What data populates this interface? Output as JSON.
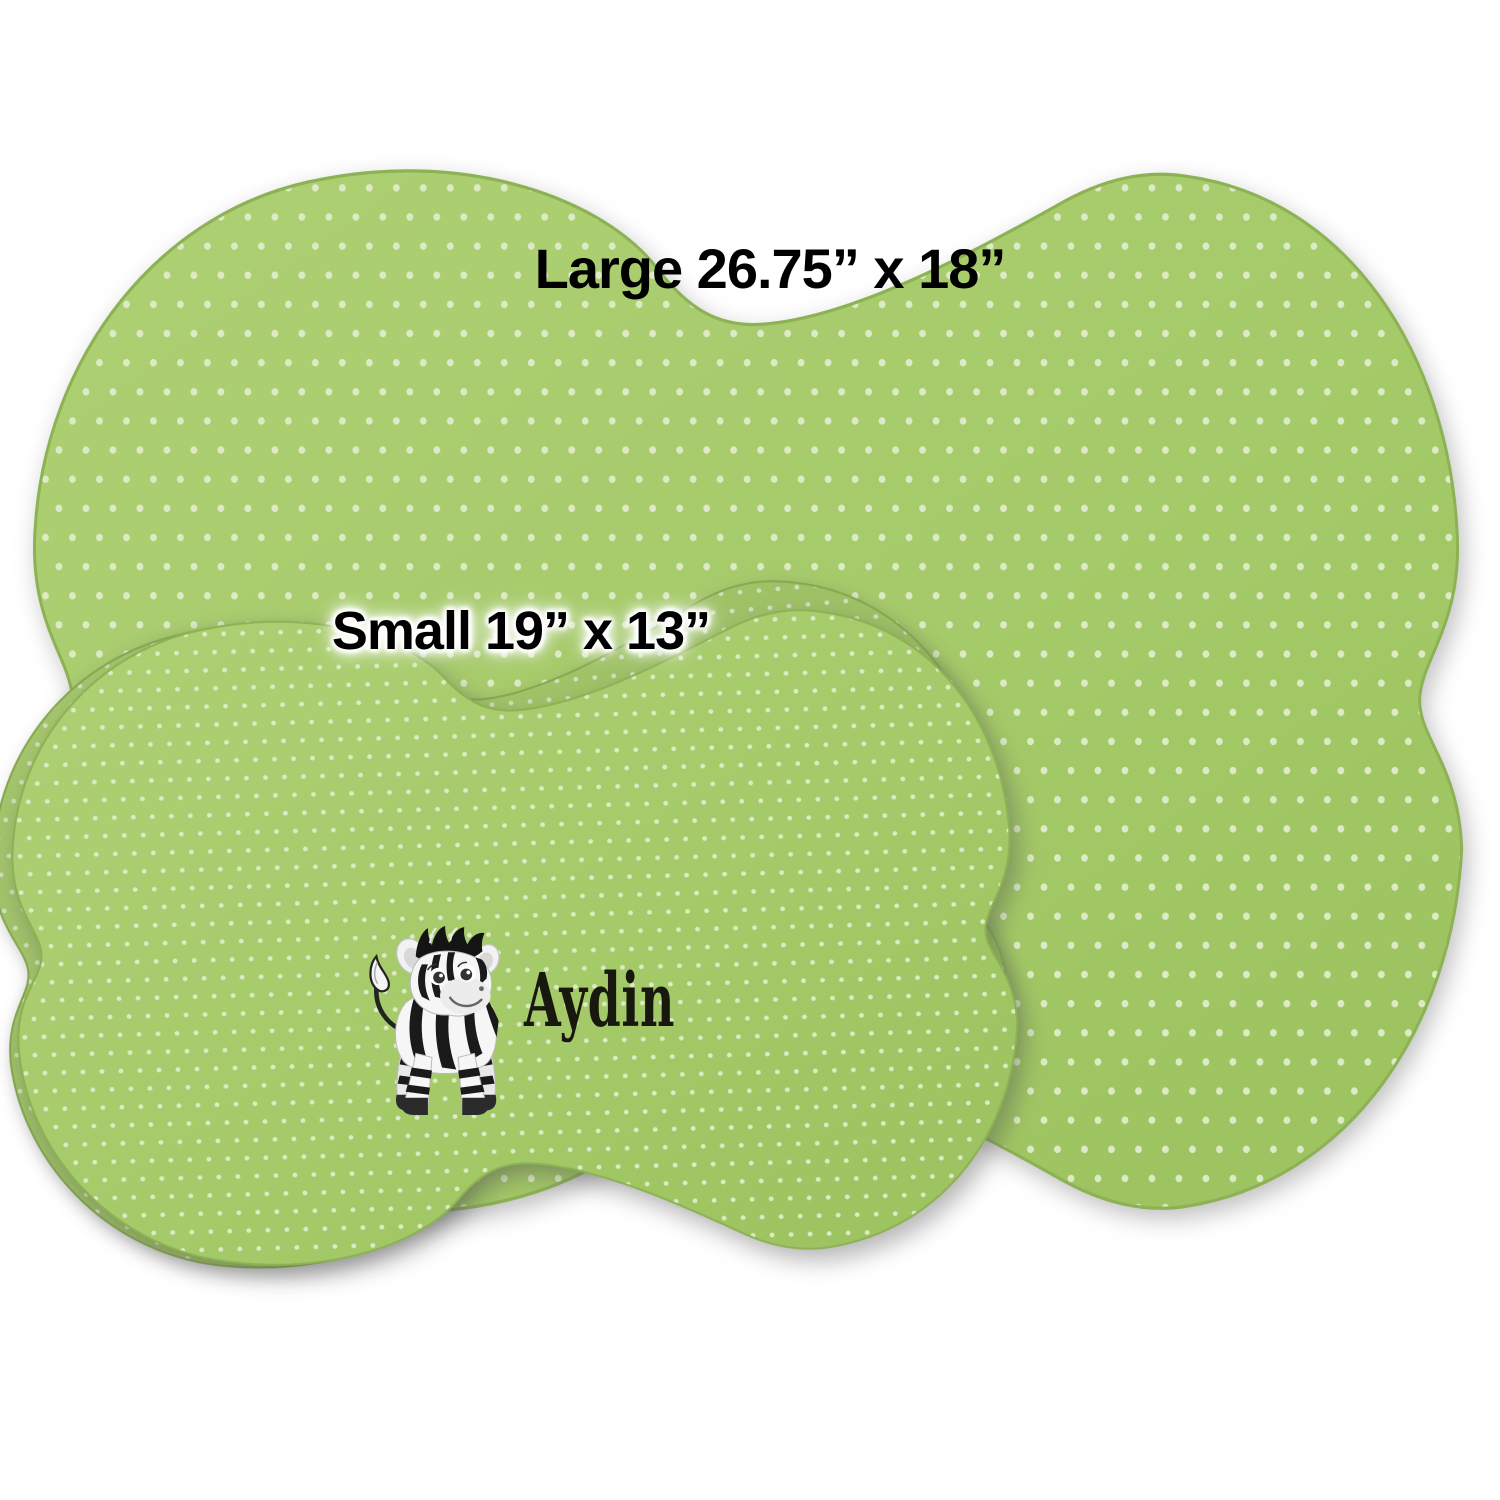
{
  "product_preview": {
    "large_size_label": "Large 26.75” x 18”",
    "small_size_label": "Small 19” x 13”",
    "personalized_name": "Aydin"
  },
  "design": {
    "pattern_name": "polka-dots",
    "illustration_name": "baby-zebra",
    "mat_green": "#a5ca69",
    "mat_green_light": "#aed074",
    "mat_green_dark": "#9bc25e",
    "dot_color": "#dcebc5",
    "edge_color": "#8cb254",
    "label_text_color": "#000000",
    "name_text_color": "#18180e"
  }
}
